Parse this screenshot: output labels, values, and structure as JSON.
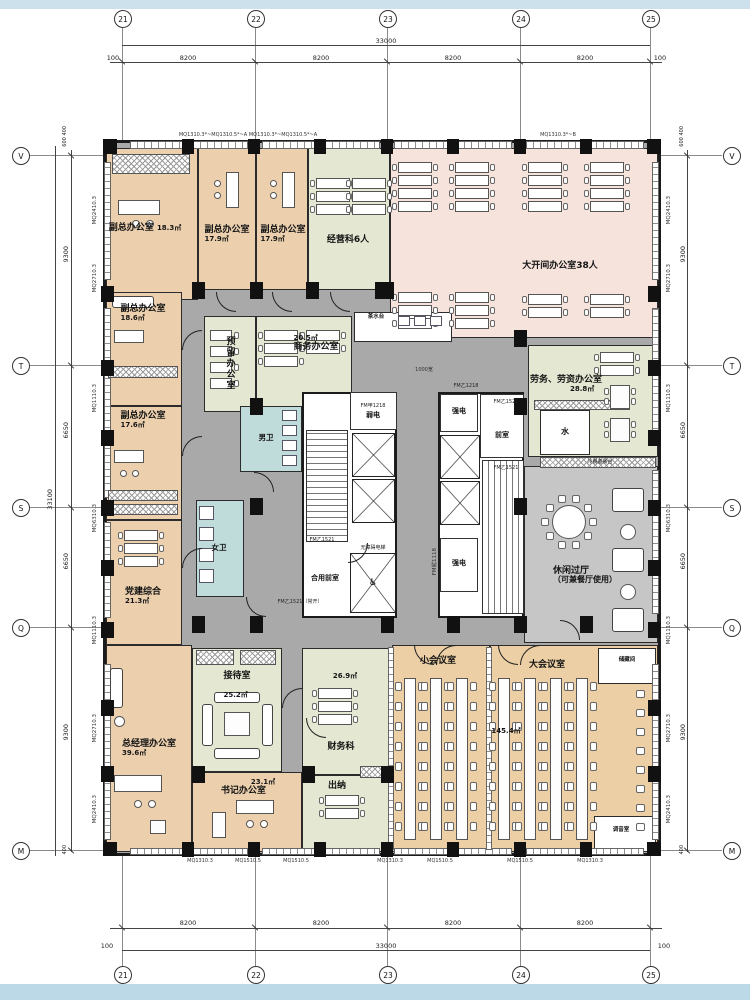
{
  "drawing": {
    "type": "office-floor-plan"
  },
  "grid": {
    "cols": [
      "21",
      "22",
      "23",
      "24",
      "25"
    ],
    "rows": [
      "V",
      "T",
      "S",
      "Q",
      "M"
    ],
    "top": {
      "total": "33000",
      "edge_left": "100",
      "edge_right": "100",
      "segments": [
        "8200",
        "8200",
        "8200",
        "8200"
      ]
    },
    "bottom": {
      "total": "33000",
      "edge_left": "100",
      "edge_right": "100",
      "segments": [
        "8200",
        "8200",
        "8200",
        "8200"
      ]
    },
    "left": {
      "total": "33100",
      "edge_top": "600 400",
      "edge_bottom": "400",
      "segments": [
        "9300",
        "6650",
        "6650",
        "9300"
      ]
    },
    "right": {
      "edge_top": "600 400",
      "edge_bottom": "400",
      "segments": [
        "9300",
        "6650",
        "6650",
        "9300"
      ]
    }
  },
  "wall_tags": {
    "left": [
      "MQ2410.3",
      "MQ2710.3",
      "MQ1110.3",
      "MQ6310.3",
      "MQ1110.3",
      "MQ2710.3",
      "MQ2410.3"
    ],
    "right": [
      "MQ2410.3",
      "MQ2710.3",
      "MQ1110.3",
      "MQ6310.3",
      "MQ1110.3",
      "MQ2710.3",
      "MQ2410.3"
    ],
    "top": [
      "MQ1310.3*~MQ1310.5*~A",
      "MQ1310.3*~MQ1310.5*~A",
      "MQ1310.3*~B"
    ],
    "bottom": [
      "MQ1310.3",
      "MQ1510.5",
      "MQ1510.5",
      "MQ1310.3",
      "MQ1510.5",
      "MQ1510.5",
      "MQ1310.3"
    ]
  },
  "rooms": {
    "deputy_office_1": {
      "label": "副总办公室",
      "area": "18.3㎡"
    },
    "deputy_office_2": {
      "label": "副总办公室",
      "area": "17.9㎡"
    },
    "deputy_office_3": {
      "label": "副总办公室",
      "area": "17.9㎡"
    },
    "operations_office": {
      "label": "经营科6人"
    },
    "open_office": {
      "label": "大开间办公室38人"
    },
    "deputy_office_4": {
      "label": "副总办公室",
      "area": "18.6㎡"
    },
    "deputy_office_5": {
      "label": "副总办公室",
      "area": "17.6㎡"
    },
    "reserved_office": {
      "label": "预留办公室"
    },
    "business_office": {
      "label": "商务办公室",
      "area": "20.5㎡"
    },
    "labor_office": {
      "label": "劳务、劳资办公室",
      "area": "28.8㎡"
    },
    "water_room": {
      "label": "水"
    },
    "leisure_hall": {
      "label": "休闲过厅",
      "sublabel": "（可兼餐厅使用）"
    },
    "party_building": {
      "label": "党建综合",
      "area": "21.3㎡"
    },
    "mens_toilet": {
      "label": "男卫"
    },
    "womens_toilet": {
      "label": "女卫"
    },
    "reception_room": {
      "label": "接待室",
      "area": "25.2㎡"
    },
    "gm_office": {
      "label": "总经理办公室",
      "area": "39.6㎡"
    },
    "secretary_office": {
      "label": "书记办公室",
      "area": "23.1㎡"
    },
    "finance_office": {
      "label": "财务科",
      "area": "26.9㎡"
    },
    "cashier": {
      "label": "出纳"
    },
    "small_meeting": {
      "label": "小会议室"
    },
    "large_meeting": {
      "label": "大会议室",
      "area": "145.4㎡"
    },
    "storage": {
      "label": "储藏间"
    },
    "sound_room": {
      "label": "调音室"
    },
    "tea_station": {
      "label": "茶水台"
    },
    "buffet_counter": {
      "label": "冷餐备餐台"
    }
  },
  "core": {
    "weak_power_door": "FM甲1218",
    "weak_power": "弱电",
    "strong_power_top": "强电",
    "strong_power_bottom": "强电",
    "anteroom": "前室",
    "shared_anteroom": "合用前室",
    "accessible_elevator": "无障碍电梯",
    "wheelchair_icon": "♿",
    "door_top": "FM乙1218",
    "door_1521_a": "FM乙1521",
    "door_1521_b": "FM乙1521",
    "door_1521_c": "FM乙1521",
    "door_1521_open": "FM乙1521（常开）",
    "door_1118": "FM丙1118",
    "corridor_width_note": "1000宽"
  },
  "colors": {
    "office_peach": "#ecd0ae",
    "green": "#e4e8d3",
    "open_pink": "#f6e3dc",
    "meeting_tan": "#eccfa4",
    "toilet_blue": "#bfdcdb",
    "corridor": "#a9a9a9",
    "leisure_gray": "#c6c6c6",
    "band_blue": "#cde1ec"
  }
}
